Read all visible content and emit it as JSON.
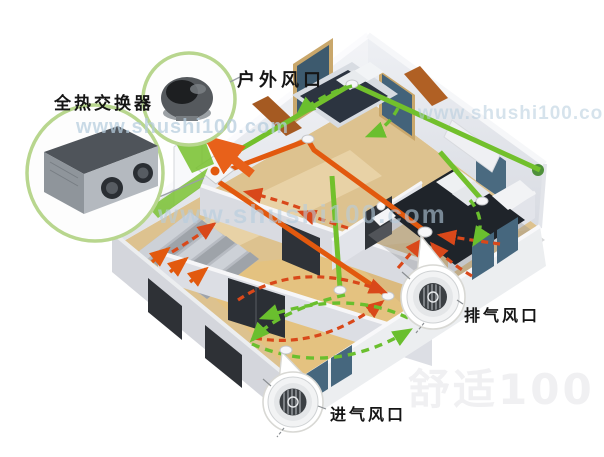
{
  "callouts": {
    "heat_exchanger": {
      "label": "全热交换器"
    },
    "outdoor_vent": {
      "label": "户外风口"
    },
    "exhaust_vent": {
      "label": "排气风口"
    },
    "intake_vent": {
      "label": "进气风口"
    }
  },
  "watermarks": {
    "url": "www.shushi100.com",
    "brand": "舒适100"
  },
  "colors": {
    "fresh_air_green": "#72c02c",
    "circulation_green": "#6abf2e",
    "exhaust_air_orange": "#e2590e",
    "circulation_red": "#d9481a",
    "wood_floor": "#ddc28f",
    "wall_white": "#eceef2",
    "watermark_blue": "#b6cdde"
  }
}
